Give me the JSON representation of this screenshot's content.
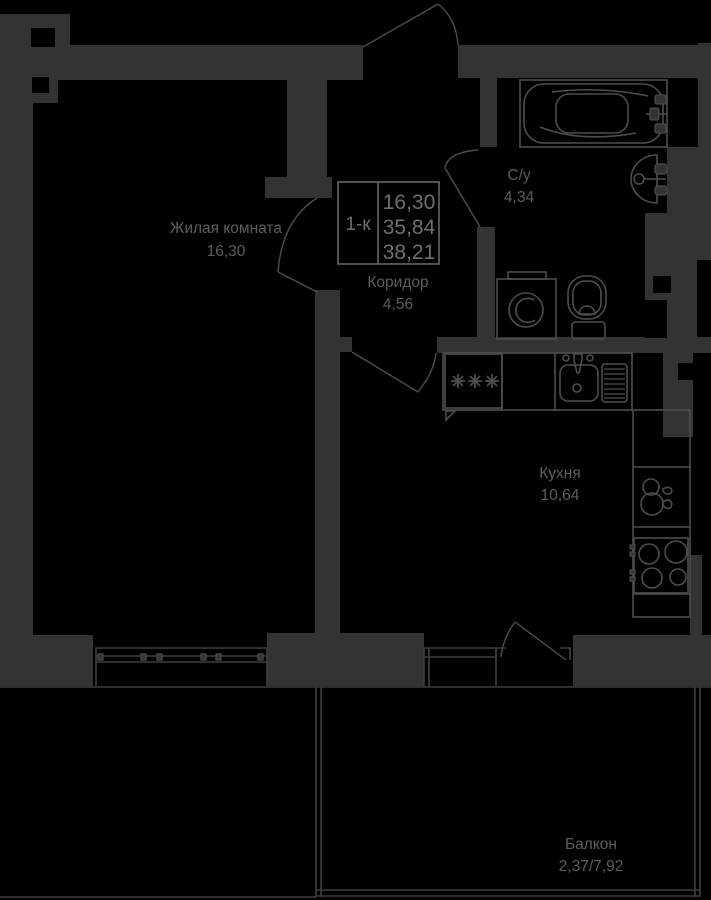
{
  "plan": {
    "type_label": "1-к",
    "colors": {
      "bg": "#000000",
      "wall": "#333333",
      "line": "#4d4d4d",
      "thin": "#3e3e3e",
      "text": "#5d5d5d",
      "info": "#6f6f6f",
      "border": "#666666"
    },
    "info_box": {
      "type": "1-к",
      "rows": [
        "16,30",
        "35,84",
        "38,21"
      ]
    },
    "rooms": [
      {
        "id": "living-room",
        "name": "Жилая комната",
        "area": "16,30"
      },
      {
        "id": "corridor",
        "name": "Коридор",
        "area": "4,56"
      },
      {
        "id": "bathroom",
        "name": "С/у",
        "area": "4,34"
      },
      {
        "id": "kitchen",
        "name": "Кухня",
        "area": "10,64"
      },
      {
        "id": "balcony",
        "name": "Балкон",
        "area": "2,37/7,92"
      }
    ],
    "fixtures": [
      {
        "id": "bathtub-icon",
        "name": "bathtub"
      },
      {
        "id": "bathroom-sink-icon",
        "name": "wall sink"
      },
      {
        "id": "washing-machine-icon",
        "name": "washing machine"
      },
      {
        "id": "toilet-icon",
        "name": "toilet"
      },
      {
        "id": "fridge-icon",
        "name": "refrigerator (snowflakes)"
      },
      {
        "id": "kitchen-sink-icon",
        "name": "kitchen sink"
      },
      {
        "id": "dish-drainer-icon",
        "name": "dish drainer"
      },
      {
        "id": "kettle-icon",
        "name": "kettle"
      },
      {
        "id": "stove-icon",
        "name": "4-burner stove"
      }
    ]
  }
}
